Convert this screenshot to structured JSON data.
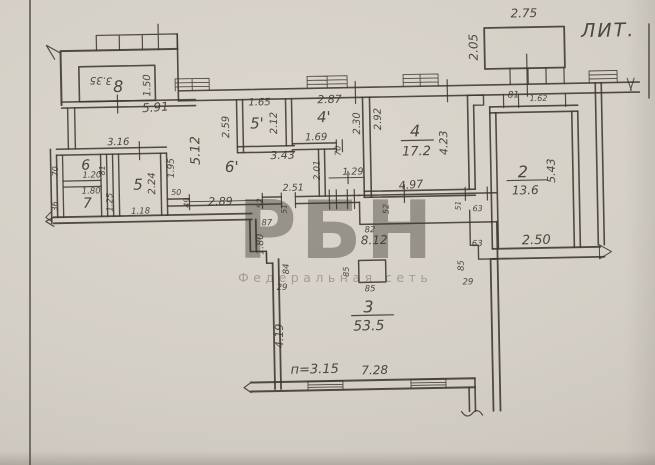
{
  "plan": {
    "litera": "ЛИТ.",
    "height_note": "п=3.15",
    "corridor_area": "8.12",
    "rooms": [
      {
        "num": "8"
      },
      {
        "num": "6"
      },
      {
        "num": "7"
      },
      {
        "num": "5"
      },
      {
        "num": "6'"
      },
      {
        "num": "5'"
      },
      {
        "num": "4'"
      },
      {
        "num": "4",
        "area": "17.2"
      },
      {
        "num": "2",
        "area": "13.6"
      },
      {
        "num": "3",
        "area": "53.5"
      }
    ]
  },
  "dims": {
    "w275": "2.75",
    "h205": "2.05",
    "w335": "3.35",
    "h150": "1.50",
    "w591": "5.91",
    "w316": "3.16",
    "h70a": "70",
    "w120": "1.20",
    "h81a": "81",
    "w180a": "1.80",
    "h125": "1.25",
    "h36": "36",
    "h224": "2.24",
    "w118": "1.18",
    "h195": "1.95",
    "w50": "50",
    "h49": "49",
    "w289": "2.89",
    "h52a": "52",
    "h512": "5.12",
    "h259": "2.59",
    "w165": "1.65",
    "h212": "2.12",
    "w343": "3.43",
    "w287": "2.87",
    "h230": "2.30",
    "w169": "1.69",
    "h70b": "70",
    "h201": "2.01",
    "w129": "1.29",
    "h292": "2.92",
    "h423": "4.23",
    "w497": "4.97",
    "w81b": "81",
    "w162": "1.62",
    "h543": "5.43",
    "w251": "2.51",
    "h51a": "51",
    "w87": "87",
    "w82": "82",
    "h52b": "52",
    "h180b": "1.80",
    "h84": "84",
    "w29a": "29",
    "h85a": "85",
    "w85b": "85",
    "h419": "4.19",
    "w728": "7.28",
    "h51b": "51",
    "w63a": "63",
    "w63b": "63",
    "w250": "2.50",
    "h85c": "85",
    "w29b": "29"
  },
  "watermark": {
    "logo": "РБН",
    "tagline": "Федеральная сеть",
    "color": "#d96570"
  }
}
